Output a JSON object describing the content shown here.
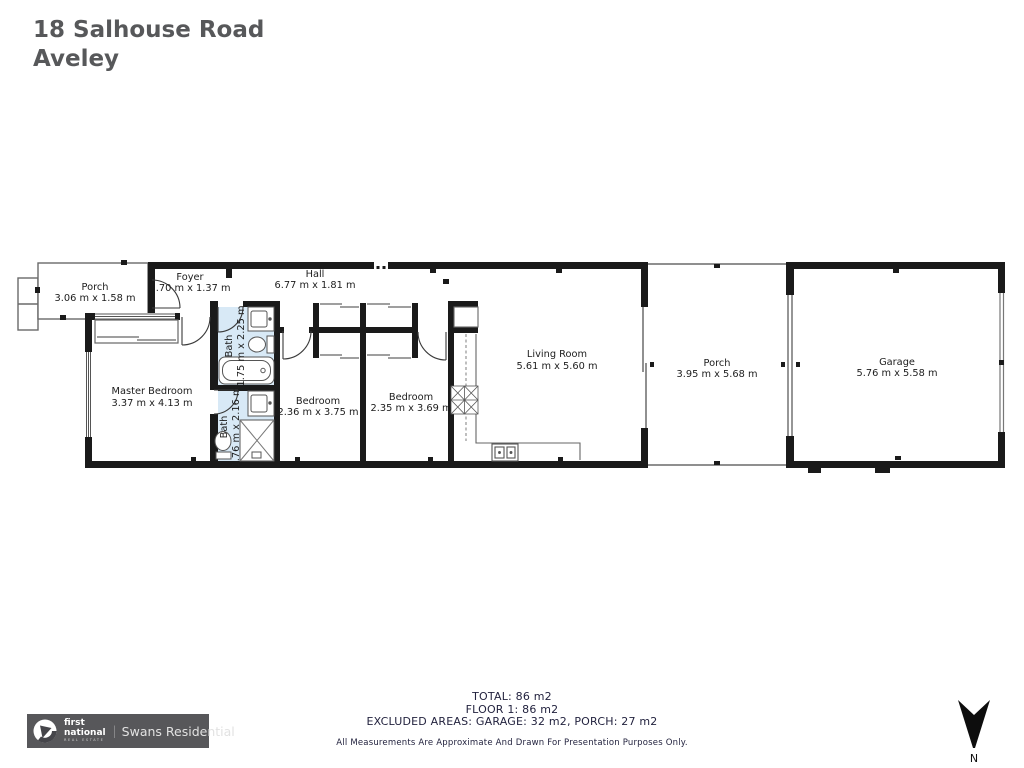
{
  "title": {
    "address_line1": "18 Salhouse Road",
    "address_line2": "Aveley"
  },
  "floorplan": {
    "rooms": {
      "porch_front": {
        "name": "Porch",
        "dims": "3.06 m x 1.58 m"
      },
      "foyer": {
        "name": "Foyer",
        "dims": "1.70 m x 1.37 m"
      },
      "hall": {
        "name": "Hall",
        "dims": "6.77 m x 1.81 m"
      },
      "master_bedroom": {
        "name": "Master Bedroom",
        "dims": "3.37 m x 4.13 m"
      },
      "bath_top": {
        "name": "Bath",
        "dims": "1.75 m x 2.25 m"
      },
      "bath_bottom": {
        "name": "Bath",
        "dims": "1.76 m x 2.16 m"
      },
      "bedroom_left": {
        "name": "Bedroom",
        "dims": "2.36 m x 3.75 m"
      },
      "bedroom_right": {
        "name": "Bedroom",
        "dims": "2.35 m x 3.69 m"
      },
      "living_room": {
        "name": "Living Room",
        "dims": "5.61 m x 5.60 m"
      },
      "porch_rear": {
        "name": "Porch",
        "dims": "3.95 m x 5.68 m"
      },
      "garage": {
        "name": "Garage",
        "dims": "5.76 m x 5.58 m"
      }
    }
  },
  "summary": {
    "total": "TOTAL: 86 m2",
    "floor": "FLOOR 1: 86 m2",
    "excluded": "EXCLUDED AREAS: GARAGE: 32 m2, PORCH: 27 m2",
    "disclaimer": "All Measurements Are Approximate And Drawn For Presentation Purposes Only."
  },
  "branding": {
    "brand_line1": "first",
    "brand_line2": "national",
    "brand_sub": "REAL ESTATE",
    "divider": "|",
    "agency": "Swans Residential"
  },
  "compass": {
    "north_label": "N"
  },
  "colors": {
    "wall": "#1a1a1a",
    "bath_fill": "#d8e9f6",
    "summary_text": "#23233f",
    "title_text": "#57585a",
    "logo_bg": "#57575a"
  }
}
